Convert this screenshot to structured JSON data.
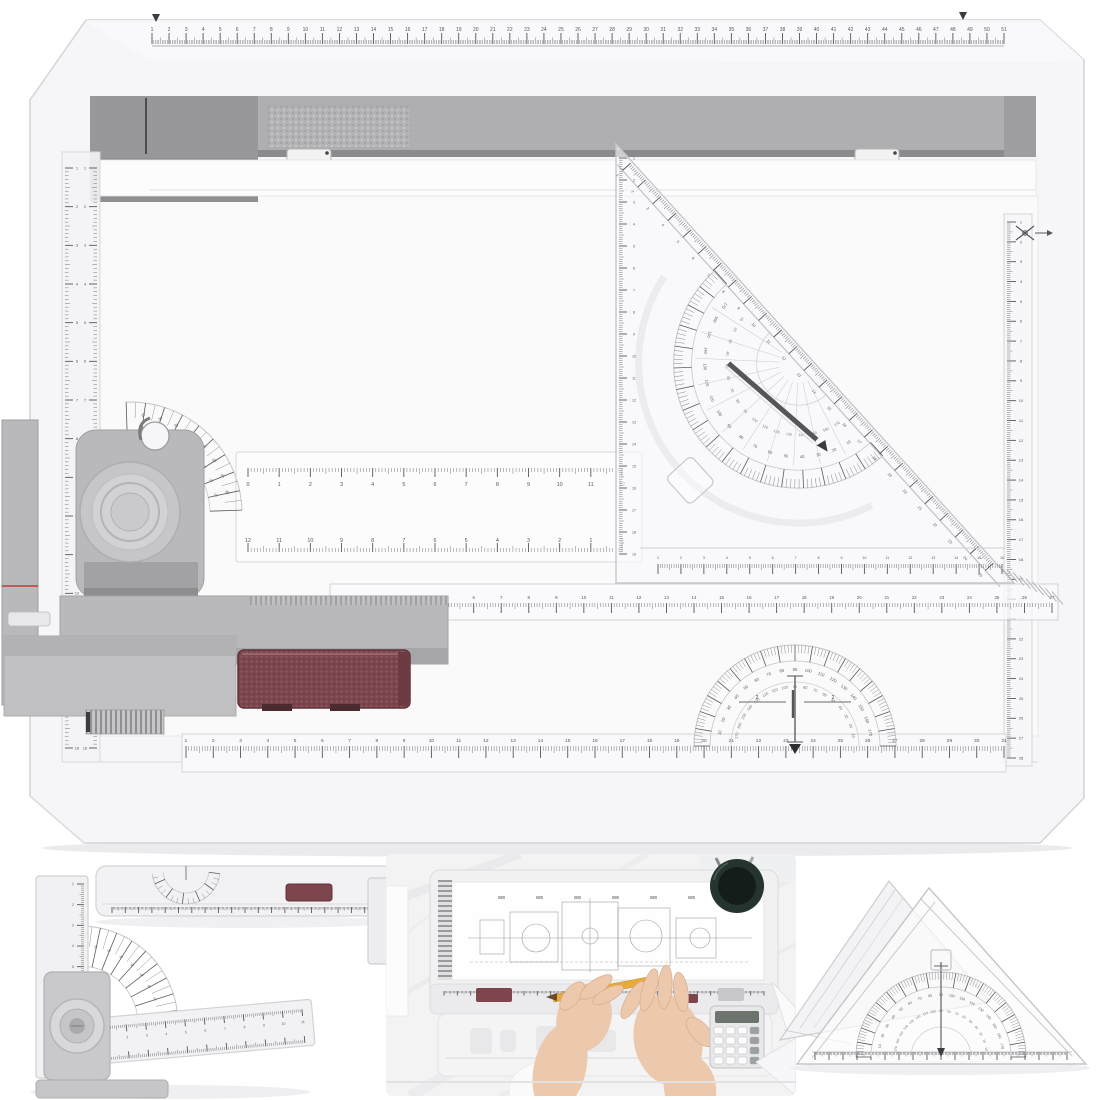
{
  "meta": {
    "subject": "Metric A3 drafting drawing board set with parallel sliding rulers, protractor head, set squares and protractors",
    "panels": [
      "main drafting board product view",
      "adjustable angle-ruler detail",
      "sliding arm with dial detail",
      "drawing board in use photo",
      "set-square with protractor detail"
    ]
  },
  "colors": {
    "bg": "#ffffff",
    "board_fill": "#f6f6f8",
    "board_edge": "#d4d4d8",
    "surface": "#fafafb",
    "clamp_bar": "#afafb1",
    "clamp_cap": "#98989a",
    "clamp_shadow": "#8b8b8d",
    "metal_gray": "#b9b9bb",
    "metal_dark": "#96969a",
    "metal_light": "#d6d6d8",
    "maroon": "#7d464d",
    "maroon_dark": "#5c3237",
    "maroon_light": "#9c646c",
    "tick": "#45454a",
    "tick_soft": "#8f8f94",
    "clear_fill": "rgba(248,248,251,0.62)",
    "clear_edge": "#c7c7cb",
    "red_line": "#c23b3b",
    "skin": "#ecc9ac",
    "skin_edge": "#d9ab8b",
    "pencil": "#e7ab3a",
    "pen_cup": "#26342f",
    "photo_bg": "#f3f3f4"
  },
  "annotations": {
    "bottom_protractor_left": "2",
    "bottom_protractor_right": "2"
  },
  "rulers": {
    "board_top": {
      "x": 152,
      "y": 44,
      "len": 852,
      "units": 50,
      "dir": -1,
      "minorLen": 4,
      "midLen": 6.5,
      "majorLen": 11,
      "font": 5.0,
      "numStart": 1,
      "numDy": -13
    },
    "board_bottom": {
      "x": 186,
      "y": 746,
      "len": 818,
      "units": 30,
      "dir": 1,
      "minorLen": 5,
      "midLen": 7,
      "majorLen": 12,
      "font": 4.8,
      "numStart": 1,
      "numDy": -4
    },
    "arm_long": {
      "x": 336,
      "y": 603,
      "len": 716,
      "units": 26,
      "dir": 1,
      "minorLen": 4,
      "midLen": 6,
      "majorLen": 10,
      "font": 4.4,
      "numStart": 1,
      "numDy": -4
    },
    "arm_double_top": {
      "x": 248,
      "y": 468,
      "len": 374,
      "units": 12,
      "dir": 1,
      "minorLen": 4,
      "midLen": 6,
      "majorLen": 9,
      "font": 5.4,
      "numStart": 0,
      "numDy": 18
    },
    "arm_double_bottom": {
      "x": 248,
      "y": 552,
      "len": 374,
      "units": 12,
      "dir": -1,
      "minorLen": 4,
      "midLen": 6,
      "majorLen": 9,
      "font": 5.4,
      "numStart": 12,
      "numStep": -1,
      "numDy": -10
    },
    "left_rail_inner": {
      "x": 97,
      "y": 168,
      "len": 580,
      "units": 15,
      "dir": -1,
      "vertical": true,
      "minorLen": 3.5,
      "midLen": 5,
      "majorLen": 8,
      "font": 4.0,
      "numStart": 1,
      "numDx": -12
    },
    "left_rail_outer": {
      "x": 65,
      "y": 168,
      "len": 580,
      "units": 15,
      "dir": 1,
      "vertical": true,
      "minorLen": 3.5,
      "midLen": 5,
      "majorLen": 8,
      "font": 4.0,
      "numStart": 1,
      "numDx": 12
    },
    "right_ruler": {
      "x": 1007,
      "y": 222,
      "len": 536,
      "units": 27,
      "dir": 1,
      "vertical": true,
      "minorLen": 3.5,
      "midLen": 5.5,
      "majorLen": 9,
      "font": 4.0,
      "numStart": 1,
      "numDx": 14
    },
    "tri_hyp": {
      "x": 24,
      "y": 2,
      "len": 540,
      "units": 24,
      "dir": 1,
      "minorLen": 4,
      "midLen": 6,
      "majorLen": 11,
      "font": 3.8,
      "numStart": 1,
      "numDy": 19
    },
    "tri_left": {
      "x": 619,
      "y": 158,
      "len": 396,
      "units": 18,
      "dir": 1,
      "vertical": true,
      "minorLen": 3.5,
      "midLen": 5,
      "majorLen": 8,
      "font": 3.6,
      "numStart": 1,
      "numDx": 15
    },
    "tri_bottom": {
      "x": 658,
      "y": 564,
      "len": 344,
      "units": 15,
      "dir": 1,
      "minorLen": 4,
      "midLen": 6,
      "majorLen": 10,
      "font": 3.6,
      "numStart": 1,
      "numDy": -5
    },
    "au_vertical": {
      "x": 84,
      "y": 884,
      "len": 186,
      "units": 9,
      "dir": -1,
      "vertical": true,
      "minorLen": 3,
      "midLen": 4.5,
      "majorLen": 7,
      "font": 3.4,
      "numStart": 1,
      "numDx": -11
    },
    "au_horiz_top": {
      "x": 10,
      "y": -15,
      "len": 196,
      "units": 10,
      "dir": 1,
      "minorLen": 3,
      "midLen": 4.5,
      "majorLen": 7,
      "font": 3.4,
      "numStart": 1,
      "numDy": 14
    },
    "au_horiz_bot": {
      "x": 10,
      "y": 19,
      "len": 196,
      "units": 10,
      "dir": -1,
      "minorLen": 3,
      "midLen": 4.5,
      "majorLen": 7,
      "font": 0
    },
    "arm_piece_bottom": {
      "x": 112,
      "y": 907,
      "len": 266,
      "units": 20,
      "dir": 1,
      "minorLen": 2.5,
      "midLen": 3.5,
      "majorLen": 6,
      "font": 0
    },
    "photo_rail": {
      "x": 444,
      "y": 991,
      "len": 320,
      "units": 24,
      "dir": 1,
      "minorLen": 2.2,
      "midLen": 3,
      "majorLen": 4.5,
      "font": 0
    },
    "small_tri_bottom": {
      "x": 815,
      "y": 1052,
      "len": 252,
      "units": 18,
      "dir": 1,
      "minorLen": 3,
      "midLen": 4.5,
      "majorLen": 8,
      "font": 0
    }
  },
  "protractors": {
    "bottom": {
      "cx": 795,
      "cy": 746,
      "rOut": 101,
      "rIn": 85,
      "a0": 180,
      "a1": 360,
      "step": 2,
      "major": 10,
      "numR": 75,
      "numR2": 58,
      "font": 4.2,
      "extraArc": 64
    },
    "head_fan": {
      "cx": 130,
      "cy": 514,
      "rOut": 112,
      "rIn": 80,
      "a0": 268,
      "a1": 358,
      "step": 5,
      "major": 10,
      "numR": 99,
      "numR2": 87,
      "font": 3.8,
      "labelZero": 268
    },
    "triangle": {
      "cx": 285,
      "cy": 12,
      "rOut": 125,
      "rIn": 107,
      "a0": 0,
      "a1": 180,
      "step": 2,
      "major": 10,
      "numR": 95,
      "numR2": 73,
      "font": 4.0,
      "spokes": 15,
      "extraArc": 42,
      "halo": 160
    },
    "small_triangle": {
      "cx": 941,
      "cy": 1057,
      "rOut": 85,
      "rIn": 70,
      "a0": 180,
      "a1": 360,
      "step": 2,
      "major": 10,
      "numR": 61,
      "numR2": 45,
      "font": 3.5,
      "extraArc": 30
    },
    "angle_fan": {
      "cx": 80,
      "cy": 1024,
      "rOut": 98,
      "rIn": 58,
      "a0": 272,
      "a1": 352,
      "step": 5,
      "major": 10,
      "numR": 78,
      "font": 3.2,
      "labelZero": 272
    },
    "arm_dial": {
      "cx": 186,
      "cy": 870,
      "rOut": 34,
      "rIn": 23,
      "a0": 6,
      "a1": 174,
      "step": 10,
      "major": 30,
      "numR": 0,
      "font": 0
    }
  }
}
